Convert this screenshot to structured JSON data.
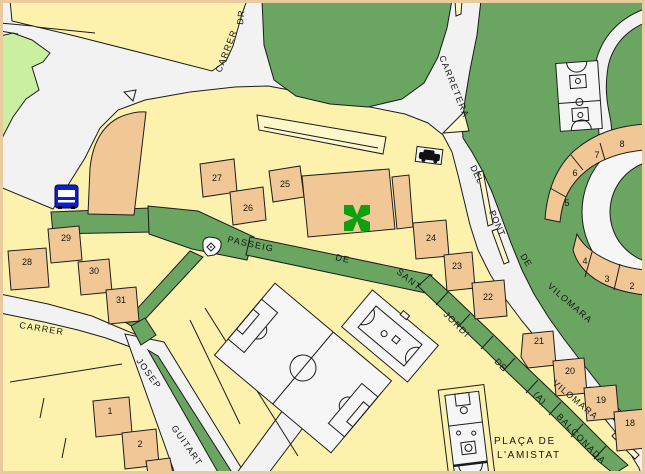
{
  "streets": {
    "carrer_dr": {
      "name": "CARRER",
      "abbr": "DR."
    },
    "carretera": {
      "name": "CARRETERA"
    },
    "del_pont_de_vilomara": {
      "w1": "DEL",
      "w2": "PONT",
      "w3": "DE",
      "w4": "VILOMARA",
      "repeat": "VILOMARA"
    },
    "passeig_de_sant_jordi": {
      "w1": "PASSEIG",
      "w2": "DE",
      "w3": "SANT",
      "w4": "JORDI"
    },
    "balconada": {
      "w1": "DE",
      "w2": "(A)",
      "w3": "BALCONADA"
    },
    "carrer_west": {
      "name": "CARRER"
    },
    "josep_guitart": {
      "w1": "JOSEP",
      "w2": "GUITART"
    }
  },
  "places": {
    "placa_line1": "PLAÇA DE",
    "placa_line2": "L'AMISTAT"
  },
  "building_numbers": {
    "n27": "27",
    "n26": "26",
    "n25": "25",
    "n24": "24",
    "n23": "23",
    "n22": "22",
    "n29": "29",
    "n28": "28",
    "n30": "30",
    "n31": "31",
    "n1": "1",
    "n2": "2",
    "n21": "21",
    "n20": "20",
    "n19": "19",
    "n18": "18",
    "n5": "5",
    "n6": "6",
    "n7": "7",
    "n8": "8",
    "n4": "4",
    "n3": "3",
    "n2_roundabout": "2"
  },
  "icons": {
    "bus_stop": "bus-stop-icon",
    "car": "car-icon",
    "pharmacy_cross": "pharmacy-cross-icon",
    "monument": "monument-icon"
  },
  "colors": {
    "block_yellow": "#FCF2AD",
    "building_tan": "#F1C795",
    "park_green": "#6AA661",
    "light_green": "#CBEFA0",
    "road_gray": "#F2F2F2",
    "court_white": "#F6F6F6",
    "island_pale_yellow": "#FDF7C9",
    "bus_blue": "#0A1ED2",
    "pharmacy_green": "#0FA00F",
    "frame_tan": "#EACB9E",
    "outline_black": "#1C1C1C"
  }
}
